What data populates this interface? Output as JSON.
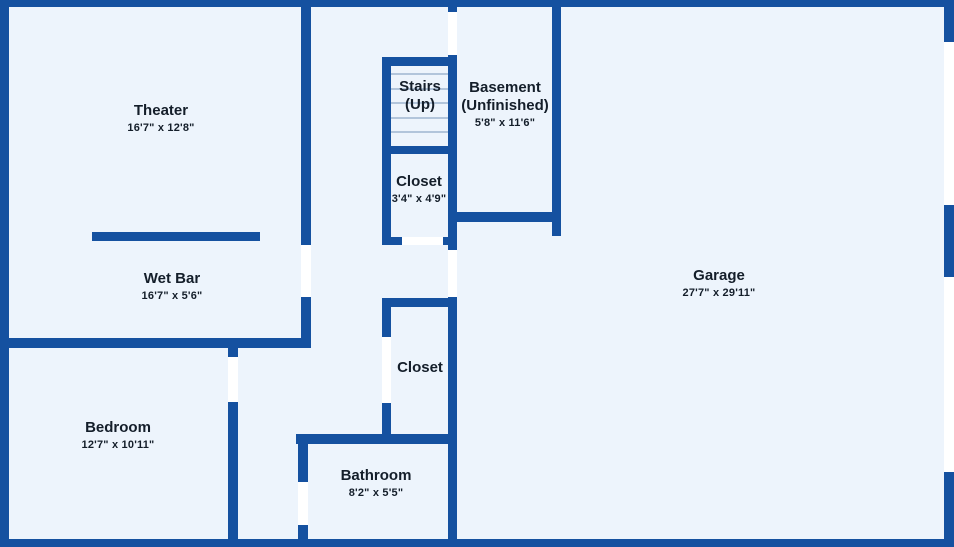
{
  "colors": {
    "wall": "#1551a0",
    "floor": "#edf4fc",
    "opening": "#ffffff",
    "tread": "#b2c5db",
    "text": "#141e2a"
  },
  "rooms": {
    "theater": {
      "name": "Theater",
      "dims": "16'7\" x 12'8\""
    },
    "wet_bar": {
      "name": "Wet Bar",
      "dims": "16'7\" x 5'6\""
    },
    "stairs": {
      "name": "Stairs\n(Up)",
      "dims": ""
    },
    "closet_upper": {
      "name": "Closet",
      "dims": "3'4\" x 4'9\""
    },
    "basement": {
      "name": "Basement\n(Unfinished)",
      "dims": "5'8\" x 11'6\""
    },
    "garage": {
      "name": "Garage",
      "dims": "27'7\" x 29'11\""
    },
    "closet_lower": {
      "name": "Closet",
      "dims": ""
    },
    "bedroom": {
      "name": "Bedroom",
      "dims": "12'7\" x 10'11\""
    },
    "bathroom": {
      "name": "Bathroom",
      "dims": "8'2\" x 5'5\""
    }
  },
  "floorplan": {
    "walls": [
      {
        "name": "wall-outer-top",
        "x": 0,
        "y": 0,
        "w": 954,
        "h": 7
      },
      {
        "name": "wall-outer-left",
        "x": 0,
        "y": 0,
        "w": 9,
        "h": 547
      },
      {
        "name": "wall-outer-bottom",
        "x": 0,
        "y": 539,
        "w": 954,
        "h": 8
      },
      {
        "name": "wall-outer-right",
        "x": 944,
        "y": 0,
        "w": 10,
        "h": 547
      },
      {
        "name": "wall-theater-right",
        "x": 301,
        "y": 0,
        "w": 10,
        "h": 348
      },
      {
        "name": "wall-central-vertical",
        "x": 448,
        "y": 0,
        "w": 9,
        "h": 547
      },
      {
        "name": "wall-stairs-closet-left",
        "x": 382,
        "y": 57,
        "w": 9,
        "h": 188
      },
      {
        "name": "wall-stairs-top",
        "x": 382,
        "y": 57,
        "w": 75,
        "h": 9
      },
      {
        "name": "wall-stairs-bottom",
        "x": 382,
        "y": 146,
        "w": 75,
        "h": 8
      },
      {
        "name": "wall-closet-upper-bottom",
        "x": 382,
        "y": 237,
        "w": 75,
        "h": 8
      },
      {
        "name": "wall-basement-right",
        "x": 552,
        "y": 0,
        "w": 9,
        "h": 236
      },
      {
        "name": "wall-basement-bottom",
        "x": 448,
        "y": 212,
        "w": 113,
        "h": 10
      },
      {
        "name": "wall-wet-bar-bottom",
        "x": 0,
        "y": 338,
        "w": 311,
        "h": 10
      },
      {
        "name": "wall-wet-bar-counter",
        "x": 92,
        "y": 232,
        "w": 168,
        "h": 9
      },
      {
        "name": "wall-bedroom-right",
        "x": 228,
        "y": 348,
        "w": 10,
        "h": 199
      },
      {
        "name": "wall-closet-lower-top",
        "x": 382,
        "y": 298,
        "w": 75,
        "h": 9
      },
      {
        "name": "wall-closet-lower-left",
        "x": 382,
        "y": 298,
        "w": 9,
        "h": 146
      },
      {
        "name": "wall-bathroom-top",
        "x": 296,
        "y": 434,
        "w": 161,
        "h": 10
      },
      {
        "name": "wall-bathroom-left",
        "x": 298,
        "y": 434,
        "w": 10,
        "h": 113
      }
    ],
    "openings": [
      {
        "name": "door-opening-theater",
        "x": 301,
        "y": 245,
        "w": 10,
        "h": 52
      },
      {
        "name": "door-opening-basement",
        "x": 448,
        "y": 12,
        "w": 9,
        "h": 43
      },
      {
        "name": "door-opening-hall-garage",
        "x": 448,
        "y": 250,
        "w": 9,
        "h": 47
      },
      {
        "name": "door-opening-closet-upper",
        "x": 402,
        "y": 237,
        "w": 41,
        "h": 8
      },
      {
        "name": "door-opening-bedroom",
        "x": 228,
        "y": 357,
        "w": 10,
        "h": 45
      },
      {
        "name": "door-opening-closet-lower",
        "x": 382,
        "y": 337,
        "w": 9,
        "h": 66
      },
      {
        "name": "door-opening-bathroom",
        "x": 298,
        "y": 482,
        "w": 10,
        "h": 43
      },
      {
        "name": "garage-door-opening-upper",
        "x": 944,
        "y": 42,
        "w": 10,
        "h": 163
      },
      {
        "name": "garage-door-opening-lower",
        "x": 944,
        "y": 277,
        "w": 10,
        "h": 195
      }
    ],
    "stair_treads": [
      {
        "x": 391,
        "y": 73,
        "w": 57,
        "h": 2
      },
      {
        "x": 391,
        "y": 88,
        "w": 57,
        "h": 2
      },
      {
        "x": 391,
        "y": 102,
        "w": 57,
        "h": 2
      },
      {
        "x": 391,
        "y": 117,
        "w": 57,
        "h": 2
      },
      {
        "x": 391,
        "y": 131,
        "w": 57,
        "h": 2
      }
    ]
  }
}
